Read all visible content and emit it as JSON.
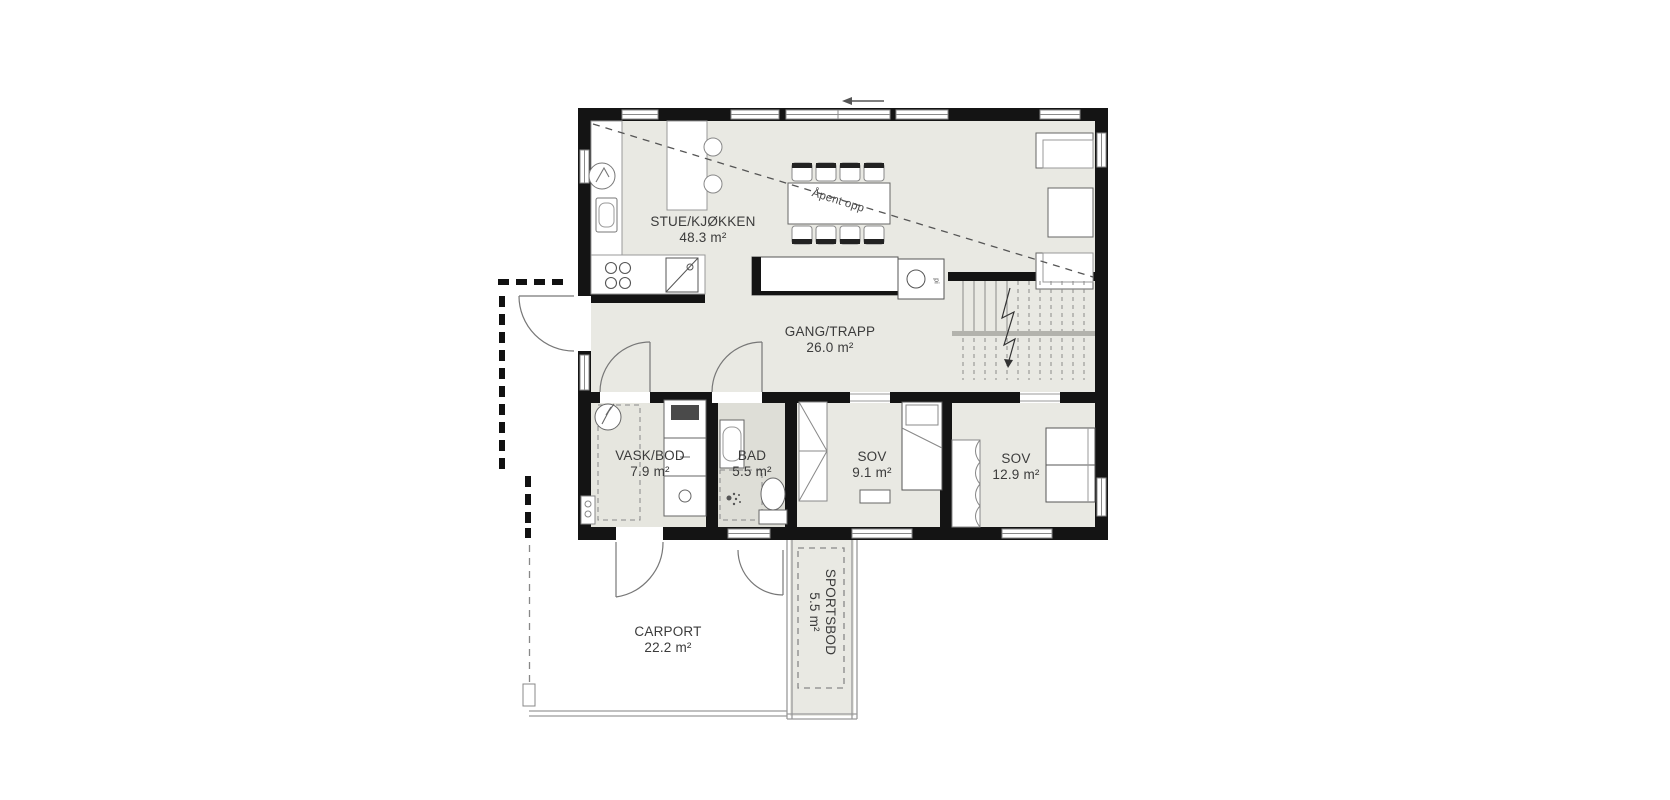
{
  "plan": {
    "rooms": [
      {
        "id": "stue",
        "name": "STUE/KJØKKEN",
        "area": "48.3 m²"
      },
      {
        "id": "gang",
        "name": "GANG/TRAPP",
        "area": "26.0 m²"
      },
      {
        "id": "vask",
        "name": "VASK/BOD",
        "area": "7.9 m²"
      },
      {
        "id": "bad",
        "name": "BAD",
        "area": "5.5 m²"
      },
      {
        "id": "sov1",
        "name": "SOV",
        "area": "9.1 m²"
      },
      {
        "id": "sov2",
        "name": "SOV",
        "area": "12.9 m²"
      },
      {
        "id": "carport",
        "name": "CARPORT",
        "area": "22.2 m²"
      },
      {
        "id": "sportsbod",
        "name": "SPORTSBOD",
        "area": "5.5 m²"
      }
    ],
    "annotations": {
      "open_above": "Åpent opp",
      "fireplace": "pi"
    },
    "colors": {
      "wall": "#141414",
      "room_fill": "#e9e9e3",
      "bad_fill": "#deded7",
      "outline": "#8a8a8a",
      "text": "#3b3b3b"
    }
  }
}
